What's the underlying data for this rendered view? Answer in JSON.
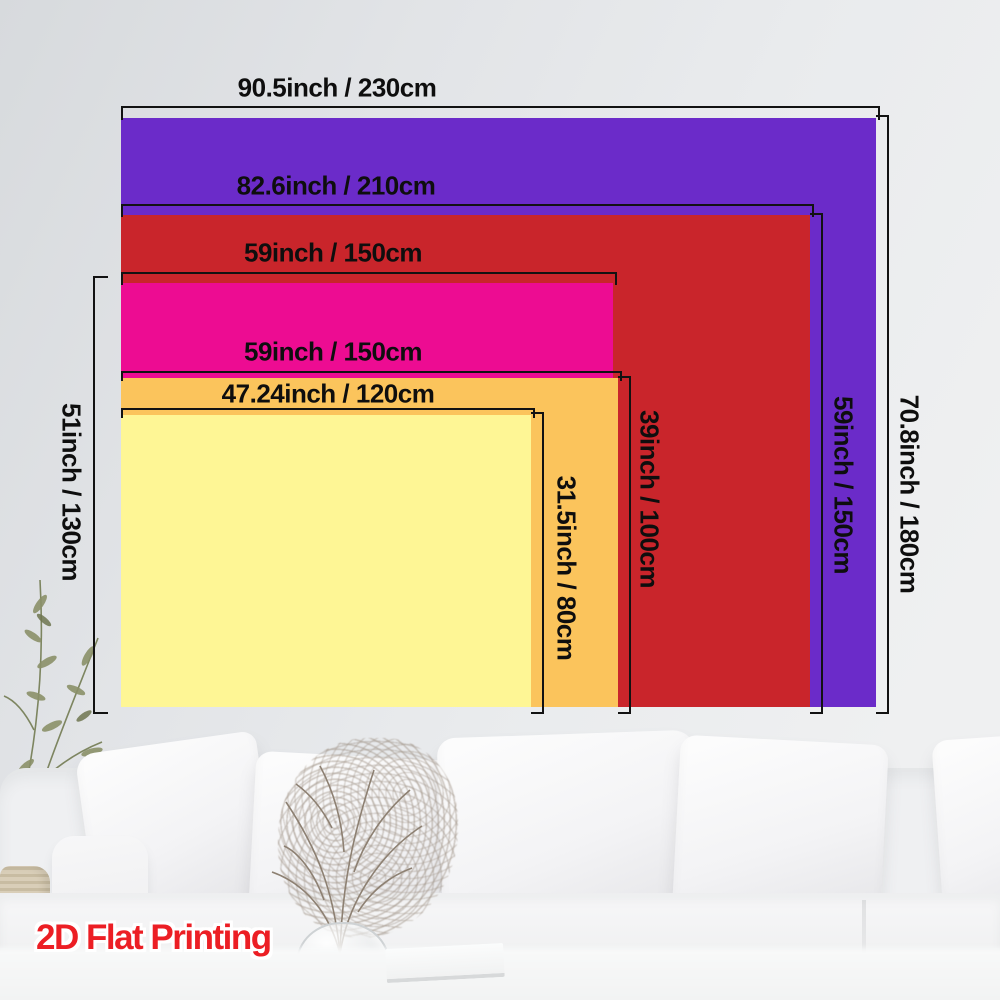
{
  "watermark": {
    "label": "2D Flat Printing",
    "color": "#EC1E24"
  },
  "scene": {
    "wall_color": "#E8EAEC",
    "sofa_color": "#F2F2F4"
  },
  "size_chart": {
    "sizes": [
      {
        "name": "230x180cm",
        "color": "#6B2BC9",
        "width_label": "90.5inch / 230cm",
        "height_label": "70.8inch / 180cm"
      },
      {
        "name": "210x150cm",
        "color": "#C9252B",
        "width_label": "82.6inch / 210cm",
        "height_label": "59inch / 150cm"
      },
      {
        "name": "150x130cm",
        "color": "#ED0C92",
        "width_label": "59inch / 150cm",
        "height_label": "51inch / 130cm"
      },
      {
        "name": "150x100cm",
        "color": "#FBC45C",
        "width_label": "59inch / 150cm",
        "height_label": "39inch / 100cm"
      },
      {
        "name": "120x80cm",
        "color": "#FEF695",
        "width_label": "47.24inch / 120cm",
        "height_label": "31.5inch / 80cm"
      }
    ]
  }
}
